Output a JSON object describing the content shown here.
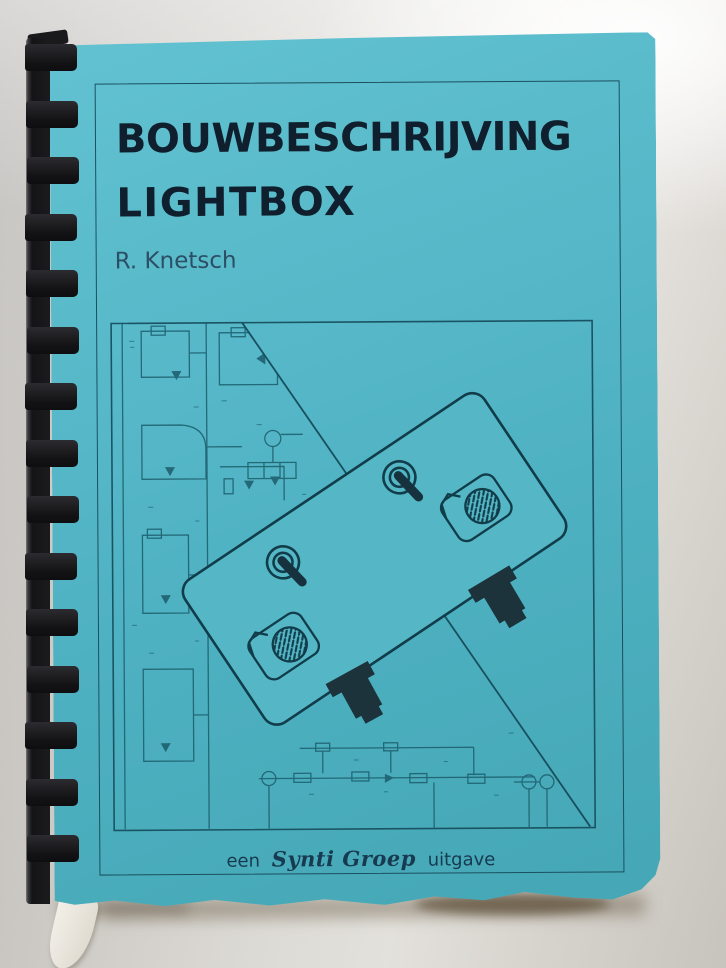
{
  "cover": {
    "title_line1": "BOUWBESCHRIJVING",
    "title_line2": "LIGHTBOX",
    "author": "R. Knetsch",
    "footer_prefix": "een",
    "footer_brand": "Synti Groep",
    "footer_suffix": "uitgave"
  },
  "colors": {
    "cover_cyan": "#4fb1c1",
    "title_ink": "#101f2d",
    "schematic_line": "#1e6170",
    "device_outline": "#113c4a",
    "binding_black": "#151517",
    "backdrop_gray": "#e2e0db"
  },
  "illustration_icons": [
    "toggle-switch-icon",
    "lamp-icon",
    "connector-icon",
    "circuit-schematic"
  ]
}
